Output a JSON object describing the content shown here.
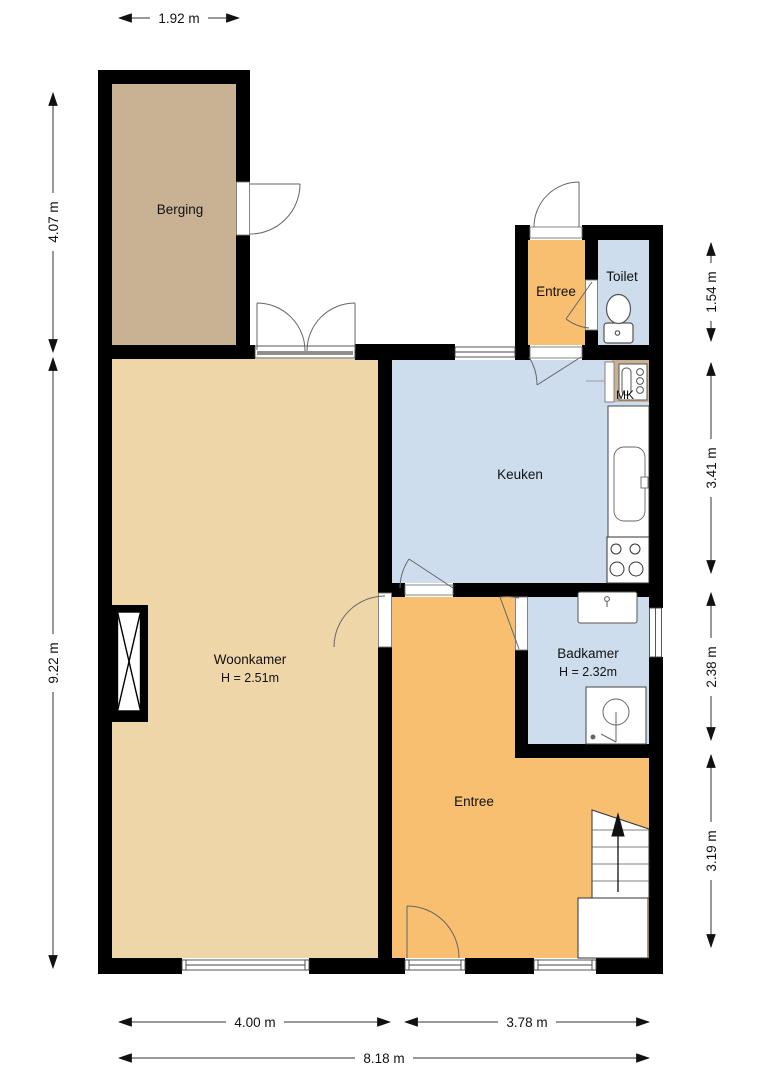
{
  "rooms": {
    "berging": {
      "name": "Berging"
    },
    "entree_top": {
      "name": "Entree"
    },
    "toilet": {
      "name": "Toilet"
    },
    "meter_cupboard": {
      "name": "MK"
    },
    "keuken": {
      "name": "Keuken"
    },
    "woonkamer": {
      "name": "Woonkamer",
      "ceiling_height": "H = 2.51m"
    },
    "badkamer": {
      "name": "Badkamer",
      "ceiling_height": "H = 2.32m"
    },
    "entree_main": {
      "name": "Entree"
    }
  },
  "dimensions": {
    "top_berging_width": "1.92 m",
    "left_upper": "4.07 m",
    "left_lower": "9.22 m",
    "right_toilet": "1.54 m",
    "right_kitchen": "3.41 m",
    "right_bath": "2.38 m",
    "right_entree": "3.19 m",
    "bottom_living": "4.00 m",
    "bottom_entree": "3.78 m",
    "bottom_total": "8.18 m"
  },
  "colors": {
    "wall": "#000000",
    "berging": "#c9b294",
    "woonkamer": "#eed6a9",
    "wet": "#cedded",
    "entree": "#f8bf70",
    "threshold_band": "#8f8f8f",
    "dim_line": "#333333"
  }
}
